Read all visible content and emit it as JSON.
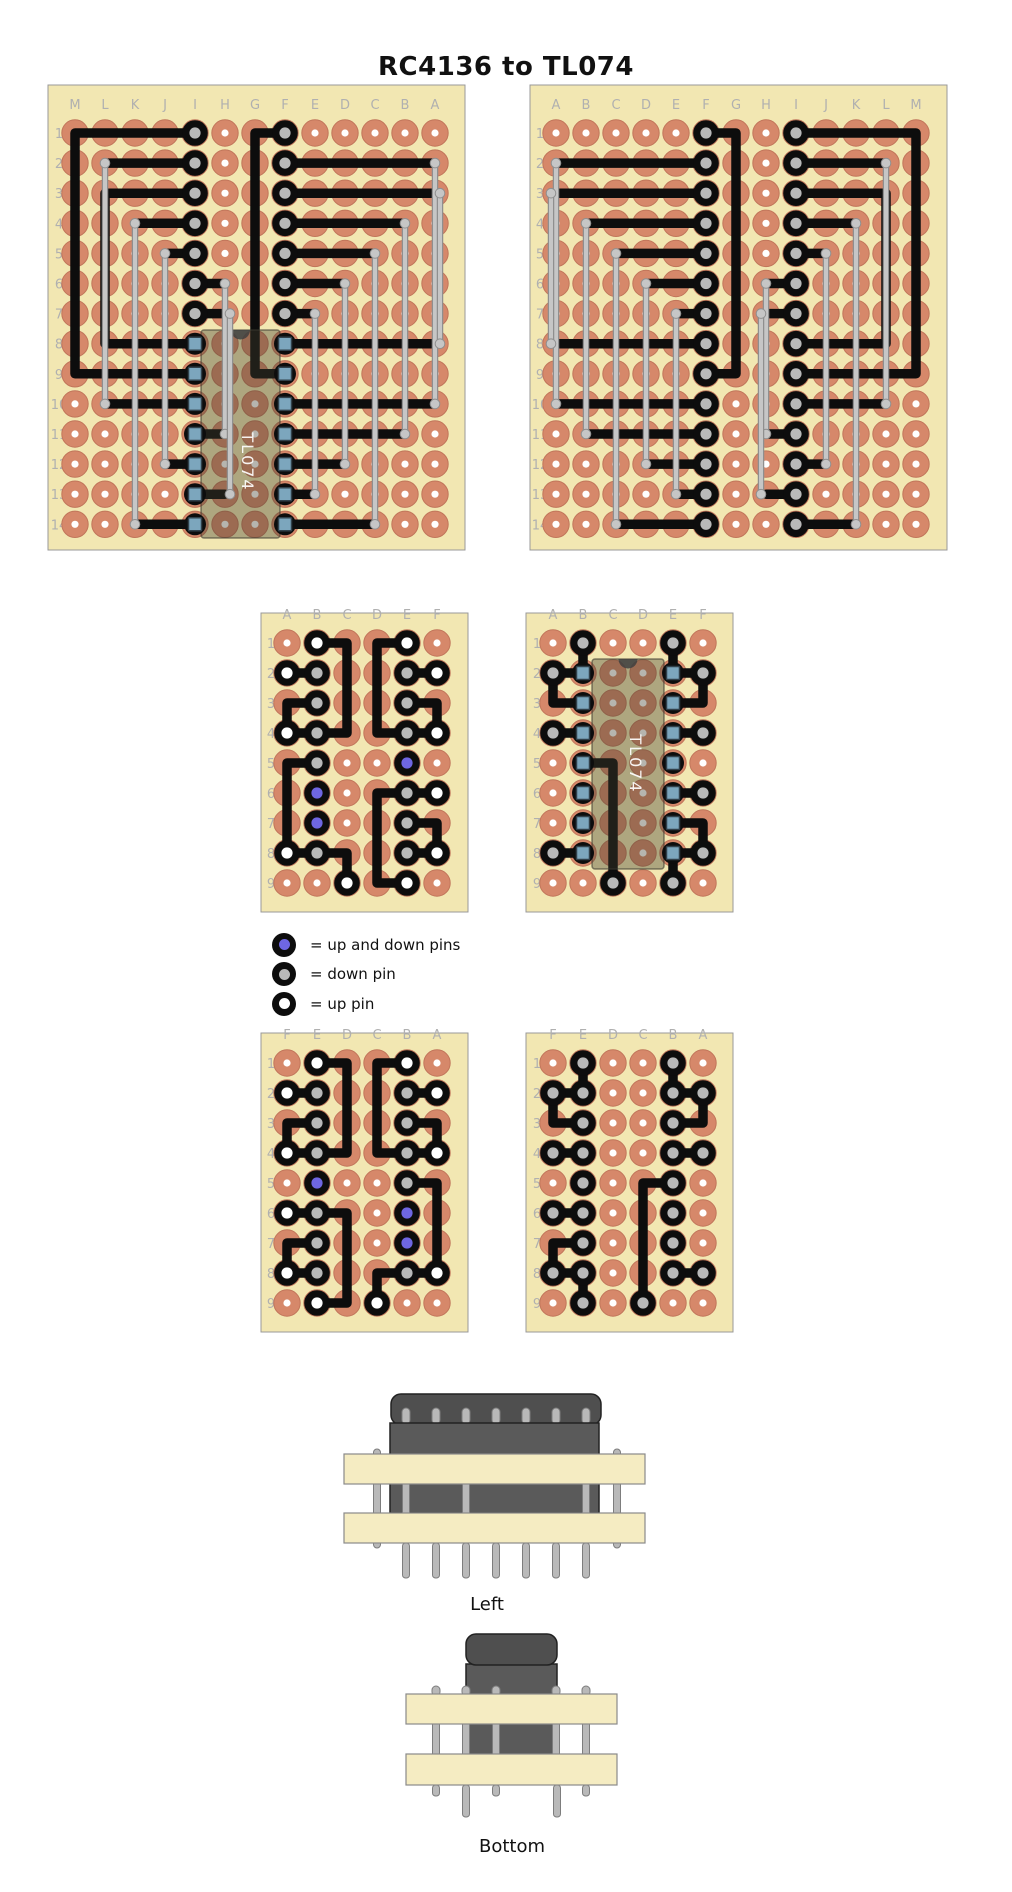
{
  "title": "RC4136 to TL074",
  "legend": {
    "items": [
      {
        "icon": "up-down-pin-icon",
        "center": "#6e66e2",
        "label": "= up and down pins"
      },
      {
        "icon": "down-pin-icon",
        "center": "#b9b9b9",
        "label": "= down pin"
      },
      {
        "icon": "up-pin-icon",
        "center": "#ffffff",
        "label": "= up pin"
      }
    ]
  },
  "colors": {
    "board_fill": "#f2e7b2",
    "board_stroke": "#999999",
    "pad": "#d6886a",
    "pad_stroke": "#c1755a",
    "hole": "#ffffff",
    "trace": "#0d0d0d",
    "ring": "#0d0d0d",
    "gray_center": "#b9b9b9",
    "white_center": "#ffffff",
    "blue_center": "#6e66e2",
    "jumper": "#c6c6c6",
    "jumper_edge": "#8f8f8f",
    "ic_fill": "rgba(62,60,46,0.38)",
    "ic_stroke": "rgba(60,58,48,0.6)",
    "ic_notch": "#3f3f3f",
    "pin_fill": "#7ca6bd",
    "pin_stroke": "#31414b",
    "chip_dark": "#4f4f4f",
    "chip_stroke": "#222222",
    "strip_fill": "#f5ecc2",
    "strip_stroke": "#8a8a8a",
    "metal": "#b9b9b9",
    "metal_stroke": "#7d7d7d"
  },
  "boards": [
    {
      "name": "top-left",
      "x": 48,
      "y": 85,
      "w": 417,
      "h": 465,
      "cols": [
        "M",
        "L",
        "K",
        "J",
        "I",
        "H",
        "G",
        "F",
        "E",
        "D",
        "C",
        "B",
        "A"
      ],
      "rows": 14,
      "col0": 75,
      "row0": 133,
      "px": 30,
      "py": 30.1,
      "gray": [
        "I1",
        "I2",
        "I3",
        "I4",
        "I5",
        "I6",
        "I7",
        "F1",
        "F2",
        "F3",
        "F4",
        "F5",
        "F6",
        "F7"
      ],
      "white": [],
      "blue": [],
      "pins": [
        "I8",
        "I9",
        "I10",
        "I11",
        "I12",
        "I13",
        "I14",
        "F8",
        "F9",
        "F10",
        "F11",
        "F12",
        "F13",
        "F14"
      ],
      "traces": [
        [
          "I1",
          "M1",
          "M9",
          "I9"
        ],
        [
          "L2",
          "I2"
        ],
        [
          "I3",
          "L3",
          "L8",
          "I8"
        ],
        [
          "K4",
          "I4"
        ],
        [
          "J5",
          "I5"
        ],
        [
          "I6",
          "H6"
        ],
        [
          "I7",
          "H7"
        ],
        [
          "L10",
          "I10"
        ],
        [
          "H11",
          "I11"
        ],
        [
          "J12",
          "I12"
        ],
        [
          "H13",
          "I13"
        ],
        [
          "K14",
          "I14"
        ],
        [
          "F1",
          "G1",
          "G9",
          "F9"
        ],
        [
          "A2",
          "F2"
        ],
        [
          "A3",
          "F3"
        ],
        [
          "B4",
          "F4"
        ],
        [
          "C5",
          "F5"
        ],
        [
          "D6",
          "F6"
        ],
        [
          "E7",
          "F7"
        ],
        [
          "A8",
          "F8"
        ],
        [
          "A10",
          "F10"
        ],
        [
          "B11",
          "F11"
        ],
        [
          "D12",
          "F12"
        ],
        [
          "E13",
          "F13"
        ],
        [
          "C14",
          "F14"
        ]
      ],
      "jumpers": [
        [
          "L2",
          "L10",
          0
        ],
        [
          "K4",
          "K14",
          0
        ],
        [
          "J5",
          "J12",
          0
        ],
        [
          "H6",
          "H11",
          0
        ],
        [
          "H7",
          "H13",
          5
        ],
        [
          "A2",
          "A10",
          0
        ],
        [
          "A3",
          "A8",
          5
        ],
        [
          "B4",
          "B11",
          0
        ],
        [
          "C5",
          "C14",
          0
        ],
        [
          "D6",
          "D12",
          0
        ],
        [
          "E7",
          "E13",
          0
        ]
      ],
      "ic": {
        "x": 201,
        "y": 330,
        "w": 79,
        "h": 208,
        "label": "TL074",
        "cx": 242,
        "cy": 462,
        "fs": 16
      }
    },
    {
      "name": "top-right",
      "x": 530,
      "y": 85,
      "w": 417,
      "h": 465,
      "cols": [
        "A",
        "B",
        "C",
        "D",
        "E",
        "F",
        "G",
        "H",
        "I",
        "J",
        "K",
        "L",
        "M"
      ],
      "rows": 14,
      "col0": 556,
      "row0": 133,
      "px": 30,
      "py": 30.1,
      "gray": [
        "I1",
        "I2",
        "I3",
        "I4",
        "I5",
        "I6",
        "I7",
        "F1",
        "F2",
        "F3",
        "F4",
        "F5",
        "F6",
        "F7",
        "I8",
        "I9",
        "I10",
        "I11",
        "I12",
        "I13",
        "I14",
        "F8",
        "F9",
        "F10",
        "F11",
        "F12",
        "F13",
        "F14"
      ],
      "white": [],
      "blue": [],
      "pins": [],
      "traces": [
        [
          "I1",
          "M1",
          "M9",
          "I9"
        ],
        [
          "L2",
          "I2"
        ],
        [
          "I3",
          "L3",
          "L8",
          "I8"
        ],
        [
          "K4",
          "I4"
        ],
        [
          "J5",
          "I5"
        ],
        [
          "I6",
          "H6"
        ],
        [
          "I7",
          "H7"
        ],
        [
          "L10",
          "I10"
        ],
        [
          "H11",
          "I11"
        ],
        [
          "J12",
          "I12"
        ],
        [
          "H13",
          "I13"
        ],
        [
          "K14",
          "I14"
        ],
        [
          "F1",
          "G1",
          "G9",
          "F9"
        ],
        [
          "A2",
          "F2"
        ],
        [
          "A3",
          "F3"
        ],
        [
          "B4",
          "F4"
        ],
        [
          "C5",
          "F5"
        ],
        [
          "D6",
          "F6"
        ],
        [
          "E7",
          "F7"
        ],
        [
          "A8",
          "F8"
        ],
        [
          "A10",
          "F10"
        ],
        [
          "B11",
          "F11"
        ],
        [
          "D12",
          "F12"
        ],
        [
          "E13",
          "F13"
        ],
        [
          "C14",
          "F14"
        ]
      ],
      "jumpers": [
        [
          "L2",
          "L10",
          0
        ],
        [
          "K4",
          "K14",
          0
        ],
        [
          "J5",
          "J12",
          0
        ],
        [
          "H6",
          "H11",
          0
        ],
        [
          "H7",
          "H13",
          -5
        ],
        [
          "A2",
          "A10",
          0
        ],
        [
          "A3",
          "A8",
          -5
        ],
        [
          "B4",
          "B11",
          0
        ],
        [
          "C5",
          "C14",
          0
        ],
        [
          "D6",
          "D12",
          0
        ],
        [
          "E7",
          "E13",
          0
        ]
      ],
      "ic": null
    },
    {
      "name": "middle-left",
      "x": 261,
      "y": 613,
      "w": 207,
      "h": 299,
      "cols": [
        "A",
        "B",
        "C",
        "D",
        "E",
        "F"
      ],
      "rows": 9,
      "col0": 287,
      "row0": 643,
      "px": 30,
      "py": 30,
      "white": [
        "B1",
        "E1",
        "A2",
        "F2",
        "A4",
        "F4",
        "F6",
        "A8",
        "F8",
        "C9",
        "E9"
      ],
      "gray": [
        "B2",
        "E2",
        "B3",
        "E3",
        "B4",
        "E4",
        "B5",
        "E6",
        "E7",
        "B8",
        "E8"
      ],
      "blue": [
        "E5",
        "B6",
        "B7"
      ],
      "pins": [],
      "traces": [
        [
          "B1",
          "C1",
          "C4",
          "A4"
        ],
        [
          "A2",
          "B2"
        ],
        [
          "B3",
          "A3",
          "A4"
        ],
        [
          "E1",
          "D1",
          "D4",
          "F4"
        ],
        [
          "E2",
          "F2"
        ],
        [
          "E3",
          "F3",
          "F4"
        ],
        [
          "B5",
          "A5",
          "A8"
        ],
        [
          "F6",
          "E6",
          "D6",
          "D9",
          "E9"
        ],
        [
          "E7",
          "F7",
          "F8"
        ],
        [
          "E8",
          "F8"
        ],
        [
          "A8",
          "B8"
        ],
        [
          "B8",
          "C8",
          "C9"
        ]
      ],
      "jumpers": [],
      "ic": null
    },
    {
      "name": "middle-right",
      "x": 526,
      "y": 613,
      "w": 207,
      "h": 299,
      "cols": [
        "A",
        "B",
        "C",
        "D",
        "E",
        "F"
      ],
      "rows": 9,
      "col0": 553,
      "row0": 643,
      "px": 30,
      "py": 30,
      "gray": [
        "B1",
        "E1",
        "A2",
        "F2",
        "A4",
        "F4",
        "F6",
        "A8",
        "F8",
        "C9",
        "E9"
      ],
      "white": [],
      "blue": [],
      "pins": [
        "B2",
        "B3",
        "B4",
        "B5",
        "B6",
        "B7",
        "B8",
        "E2",
        "E3",
        "E4",
        "E5",
        "E6",
        "E7",
        "E8"
      ],
      "traces": [
        [
          "B1",
          "B2"
        ],
        [
          "E1",
          "E2"
        ],
        [
          "A2",
          "B2"
        ],
        [
          "B3",
          "A3",
          "A2"
        ],
        [
          "E2",
          "F2"
        ],
        [
          "E3",
          "F3",
          "F2"
        ],
        [
          "A4",
          "B4"
        ],
        [
          "E4",
          "F4"
        ],
        [
          "B5",
          "C5",
          "C9"
        ],
        [
          "E6",
          "F6"
        ],
        [
          "E7",
          "F7",
          "F8"
        ],
        [
          "E8",
          "F8"
        ],
        [
          "A8",
          "B8"
        ],
        [
          "E8",
          "E9"
        ]
      ],
      "jumpers": [],
      "ic": {
        "x": 592,
        "y": 659,
        "w": 72,
        "h": 210,
        "label": "TL074",
        "cx": 630,
        "cy": 764,
        "fs": 15
      }
    },
    {
      "name": "bottom-left",
      "x": 261,
      "y": 1033,
      "w": 207,
      "h": 299,
      "cols": [
        "F",
        "E",
        "D",
        "C",
        "B",
        "A"
      ],
      "rows": 9,
      "col0": 287,
      "row0": 1063,
      "px": 30,
      "py": 30,
      "white": [
        "B1",
        "E1",
        "A2",
        "F2",
        "A4",
        "F4",
        "F6",
        "A8",
        "F8",
        "C9",
        "E9"
      ],
      "gray": [
        "B2",
        "E2",
        "B3",
        "E3",
        "B4",
        "E4",
        "B5",
        "E6",
        "E7",
        "B8",
        "E8"
      ],
      "blue": [
        "E5",
        "B6",
        "B7"
      ],
      "pins": [],
      "traces": [
        [
          "B1",
          "C1",
          "C4",
          "A4"
        ],
        [
          "A2",
          "B2"
        ],
        [
          "B3",
          "A3",
          "A4"
        ],
        [
          "E1",
          "D1",
          "D4",
          "F4"
        ],
        [
          "E2",
          "F2"
        ],
        [
          "E3",
          "F3",
          "F4"
        ],
        [
          "B5",
          "A5",
          "A8"
        ],
        [
          "F6",
          "E6",
          "D6",
          "D9",
          "E9"
        ],
        [
          "E7",
          "F7",
          "F8"
        ],
        [
          "E8",
          "F8"
        ],
        [
          "A8",
          "B8"
        ],
        [
          "B8",
          "C8",
          "C9"
        ]
      ],
      "jumpers": [],
      "ic": null
    },
    {
      "name": "bottom-right",
      "x": 526,
      "y": 1033,
      "w": 207,
      "h": 299,
      "cols": [
        "F",
        "E",
        "D",
        "C",
        "B",
        "A"
      ],
      "rows": 9,
      "col0": 553,
      "row0": 1063,
      "px": 30,
      "py": 30,
      "gray": [
        "B1",
        "E1",
        "F2",
        "E2",
        "B2",
        "A2",
        "E3",
        "B3",
        "F4",
        "E4",
        "B4",
        "A4",
        "E5",
        "B5",
        "F6",
        "E6",
        "B6",
        "E7",
        "B7",
        "F8",
        "E8",
        "B8",
        "A8",
        "C9",
        "E9"
      ],
      "white": [],
      "blue": [],
      "pins": [],
      "traces": [
        [
          "B1",
          "B2"
        ],
        [
          "E1",
          "E2"
        ],
        [
          "F2",
          "E2"
        ],
        [
          "E3",
          "F3",
          "F2"
        ],
        [
          "B2",
          "A2"
        ],
        [
          "B3",
          "A3",
          "A2"
        ],
        [
          "F4",
          "E4"
        ],
        [
          "B4",
          "A4"
        ],
        [
          "B5",
          "C5",
          "C9"
        ],
        [
          "F6",
          "E6"
        ],
        [
          "E7",
          "F7",
          "F8"
        ],
        [
          "F8",
          "E8"
        ],
        [
          "B8",
          "A8"
        ],
        [
          "E9",
          "E8"
        ]
      ],
      "jumpers": [],
      "ic": null
    }
  ],
  "side_views": {
    "left": {
      "label": "Left"
    },
    "bottom": {
      "label": "Bottom"
    }
  }
}
